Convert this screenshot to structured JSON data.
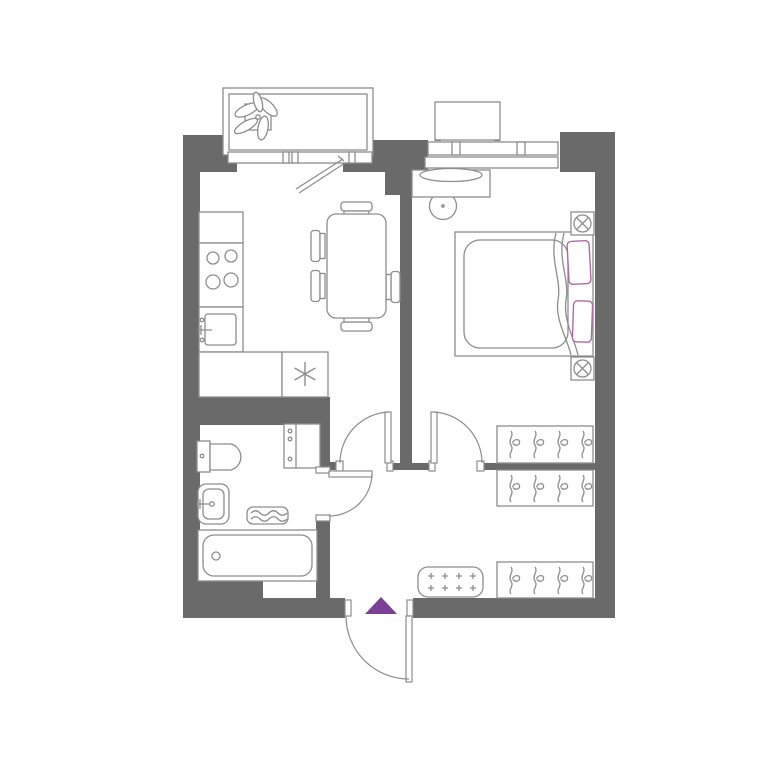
{
  "canvas": {
    "width": 768,
    "height": 768,
    "background": "#ffffff"
  },
  "colors": {
    "wall": "#6a6a6a",
    "line": "#8d8d8d",
    "fixture_fill": "#ffffff",
    "pillow": "#b168a4",
    "accent": "#7c3f97"
  },
  "floorplan": {
    "type": "one-bedroom-apartment",
    "rooms": [
      {
        "name": "balcony",
        "fixtures": [
          "potted-plant",
          "glazed-railing",
          "balcony-door"
        ]
      },
      {
        "name": "kitchen-living-room",
        "fixtures": [
          "countertop",
          "cooktop-4-burners",
          "kitchen-sink",
          "lower-counter",
          "refrigerator",
          "dining-table",
          "chair-x5"
        ]
      },
      {
        "name": "bedroom",
        "fixtures": [
          "window",
          "outdoor-ac-platform",
          "vanity-with-mirror",
          "stool",
          "double-bed",
          "pillow-x2",
          "bedside-lamp-x2",
          "wardrobe-with-hangers"
        ]
      },
      {
        "name": "bathroom",
        "fixtures": [
          "toilet",
          "washbasin",
          "bath-mat",
          "bathtub",
          "tall-cabinet"
        ]
      },
      {
        "name": "hallway",
        "fixtures": [
          "wardrobe-with-hangers-x2",
          "shoe-bench",
          "entrance-door",
          "entrance-marker-triangle"
        ]
      }
    ],
    "doors": [
      "balcony-door",
      "living-room-door",
      "bedroom-door",
      "bathroom-door",
      "entrance-door"
    ]
  }
}
